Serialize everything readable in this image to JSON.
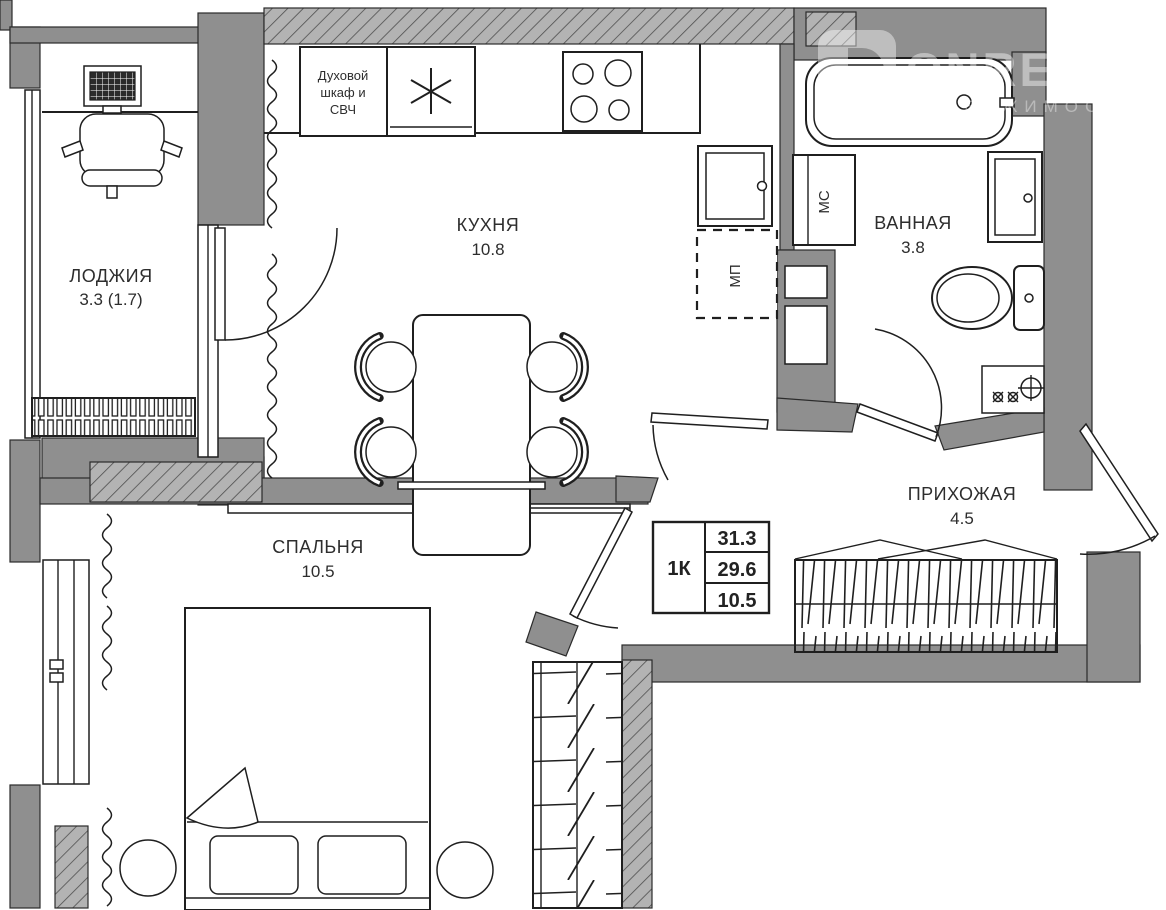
{
  "watermark": {
    "brand": "ONREALT",
    "tagline": "НЕДВИЖИМОСТЬ"
  },
  "rooms": {
    "loggia": {
      "name": "ЛОДЖИЯ",
      "area": "3.3 (1.7)"
    },
    "kitchen": {
      "name": "КУХНЯ",
      "area": "10.8"
    },
    "bathroom": {
      "name": "ВАННАЯ",
      "area": "3.8"
    },
    "hallway": {
      "name": "ПРИХОЖАЯ",
      "area": "4.5"
    },
    "bedroom": {
      "name": "СПАЛЬНЯ",
      "area": "10.5"
    }
  },
  "appliances": {
    "oven_line1": "Духовой",
    "oven_line2": "шкаф и",
    "oven_line3": "СВЧ",
    "washer_label": "МС",
    "dishwasher_label": "МП"
  },
  "info_table": {
    "apartment_type": "1К",
    "rows": [
      "31.3",
      "29.6",
      "10.5"
    ]
  },
  "colors": {
    "wall": "#8f8f8f",
    "hatch_base": "#b3b3b3",
    "line": "#1f1f1f",
    "background": "#ffffff",
    "watermark": "#ffffff"
  }
}
